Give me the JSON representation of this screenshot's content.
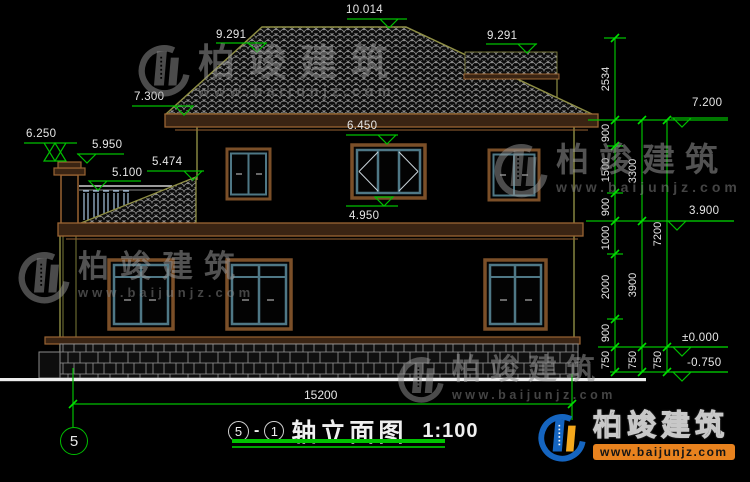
{
  "drawing": {
    "title": {
      "prefix_axis": "5",
      "dash": "-",
      "suffix_axis": "1",
      "name": "轴立面图",
      "scale": "1:100"
    },
    "axis_bubble_label": "5",
    "overall_width_dim": "15200"
  },
  "levels": {
    "ridge": "10.014",
    "left_secondary": "9.291",
    "right_secondary": "9.291",
    "left_eave": "7.300",
    "chimney_top": "6.250",
    "chimney_cap": "5.950",
    "wing_roof_top": "5.474",
    "railing_top": "5.100",
    "window_head": "6.450",
    "window_sill": "4.950",
    "right_eave": "7.200",
    "second_floor": "3.900",
    "ground": "±0.000",
    "foundation": "-0.750"
  },
  "dim_chains": {
    "inner": [
      "2534",
      "900",
      "1500",
      "900",
      "1000",
      "2000",
      "900",
      "750"
    ],
    "middle": [
      "3300",
      "3900",
      "750"
    ],
    "outer": [
      "7200",
      "750"
    ]
  },
  "watermark": {
    "company": "柏竣建筑",
    "website": "www.baijunjz.com"
  }
}
